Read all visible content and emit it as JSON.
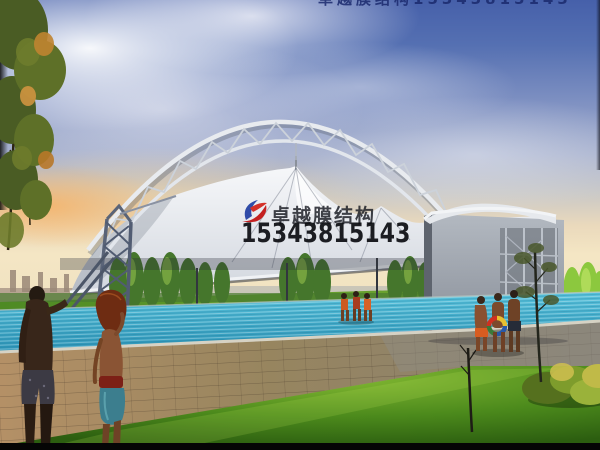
{
  "watermark": {
    "brand": "卓越膜结构",
    "phone": "15343815143",
    "top_strip": "卓越膜结构15343815143"
  },
  "scene": {
    "description": "Architectural rendering of a white tensile membrane canopy with steel arch truss over a swimming pool at sunset",
    "elements": [
      "sky",
      "clouds",
      "sunset-glow",
      "arch-truss",
      "membrane-canopy",
      "lattice-tower",
      "side-wall",
      "tree-row",
      "swimming-pool",
      "paved-deck",
      "lawn",
      "bushes",
      "foreground-couple",
      "pool-side-people"
    ]
  },
  "colors": {
    "sky_top": "#4660aa",
    "sky_horizon": "#f4e6c4",
    "sunset_glow": "#f0a860",
    "membrane": "#eef0f4",
    "steel_truss": "#6e7890",
    "pool_water": "#3aa8c8",
    "lawn_green": "#5fa223",
    "deck_pavers": "#a08a6a",
    "logo_red": "#c42020",
    "logo_blue": "#1c3aa0",
    "watermark_text": "#14161e",
    "top_strip_text": "#1b2a6e"
  }
}
